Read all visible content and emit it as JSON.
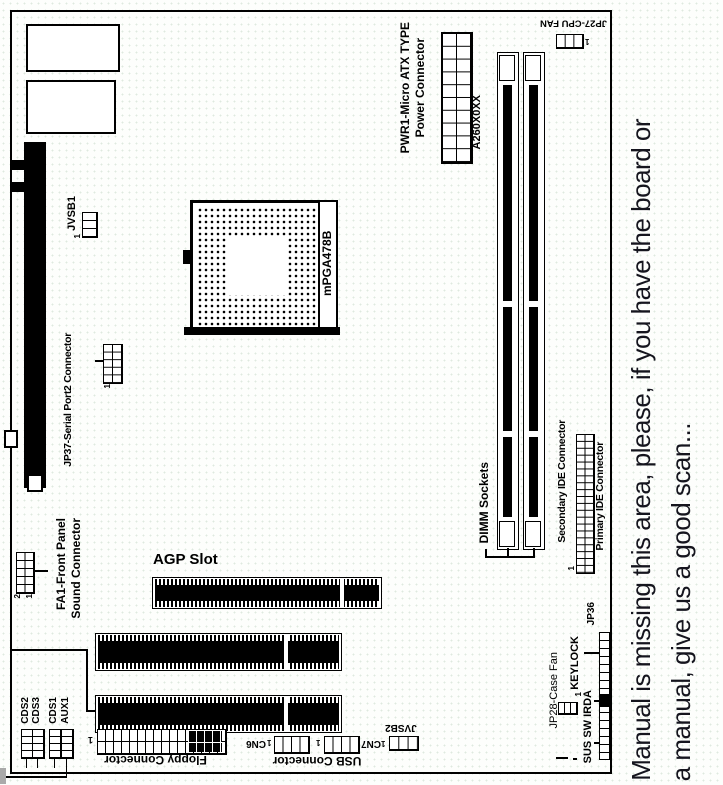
{
  "note": {
    "line1": "Manual is missing this area, please, if you have the board or",
    "line2": "a manual, give us a good scan...",
    "ink_color": "#15151e"
  },
  "diagram": {
    "labels": {
      "jvsb1": "JVSB1",
      "jp37": "JP37-Serial Port2 Connector",
      "cpu_socket": "mPGA478B",
      "pwr_type": "PWR1-Micro ATX TYPE",
      "pwr_name": "Power Connector",
      "pwr_part": "A260X0XX",
      "cpu_fan": "JP27-CPU FAN",
      "dimm": "DIMM Sockets",
      "ide_secondary": "Secondary IDE Connector",
      "ide_primary": "Primary IDE Connector",
      "fa1_line1": "FA1-Front Panel",
      "fa1_line2": "Sound Connector",
      "agp": "AGP Slot",
      "cds2": "CDS2",
      "cds3": "CDS3",
      "cds1": "CDS1",
      "aux1": "AUX1",
      "floppy": "Floppy Connector",
      "usb": "USB Connector",
      "cn7": "CN7",
      "cn6": "CN6",
      "jvsb2": "JVSB2",
      "case_fan": "JP28-Case Fan",
      "keylock": "KEYLOCK",
      "sus_sw_irda": "SUS SW IRDA",
      "jp36": "JP36"
    },
    "pins": {
      "p1": "1",
      "p2": "2"
    },
    "line_color": "#000000"
  }
}
